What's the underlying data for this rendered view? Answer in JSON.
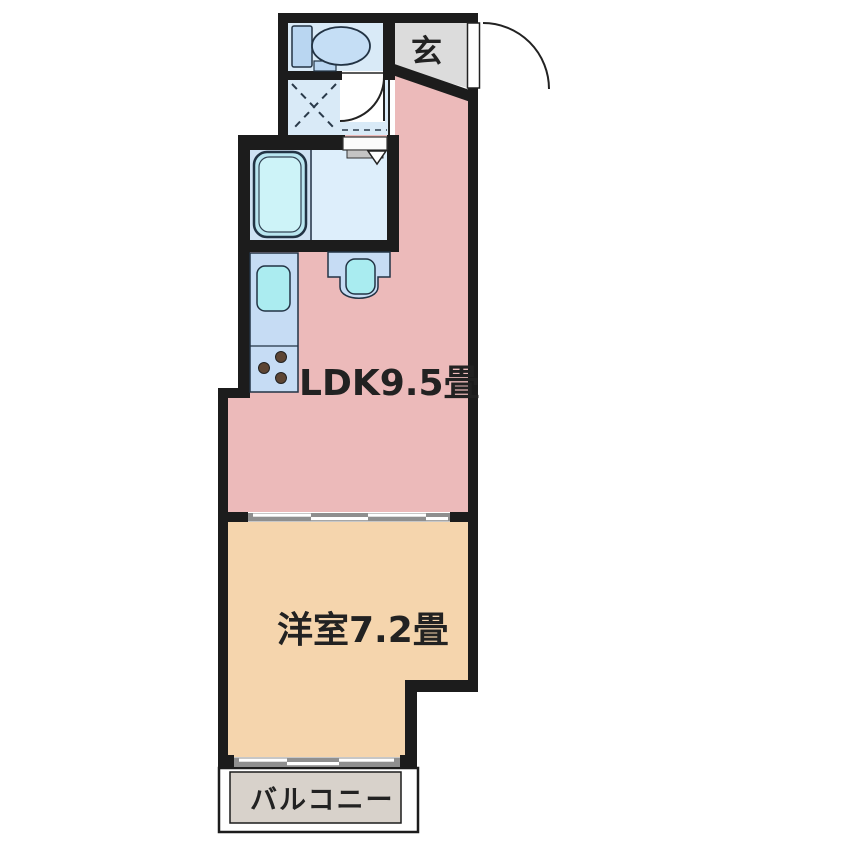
{
  "plan": {
    "type": "apartment-floor-plan",
    "rooms": {
      "genkan": {
        "label": "玄"
      },
      "ldk": {
        "label": "LDK9.5畳"
      },
      "western_room": {
        "label": "洋室7.2畳"
      },
      "balcony": {
        "label": "バルコニー"
      }
    },
    "fixtures": [
      "toilet",
      "bathtub",
      "washbasin",
      "kitchen-sink",
      "gas-stove",
      "washing-machine-space",
      "entrance-door",
      "toilet-door",
      "sliding-partition",
      "balcony-window"
    ],
    "colors": {
      "wall": "#1c1c1c",
      "ldk_floor": "#ecbaba",
      "western_floor": "#f5d5ad",
      "genkan_floor": "#dcdcdc",
      "balcony_floor": "#d8d2cb",
      "wet_area_floor": "#d9eaf7",
      "bath_floor": "#cfe2f3",
      "fixture_body": "#c6dcf4",
      "basin_cyan": "#abecf0",
      "tub_fill": "#cdf3f8",
      "burner": "#5d4533"
    }
  }
}
